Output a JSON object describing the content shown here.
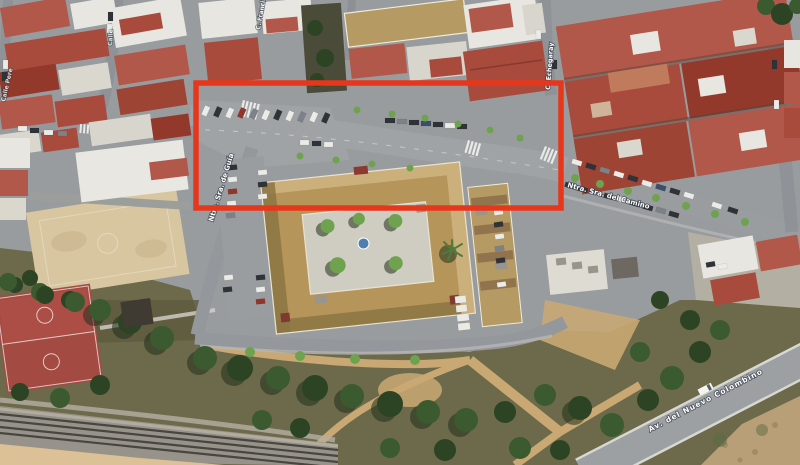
{
  "map": {
    "street_labels": [
      {
        "id": "ntra-sra-de-guia",
        "text": "Ntra. Sra. de Guía"
      },
      {
        "id": "ntra-sra-del-camino",
        "text": "Ntra. Sra. del Camino"
      },
      {
        "id": "echegaray",
        "text": "C. Echegaray"
      },
      {
        "id": "francisco",
        "text": "C. Francisco"
      },
      {
        "id": "calle-pere",
        "text": "Calle Pere"
      },
      {
        "id": "calle",
        "text": "Calle"
      },
      {
        "id": "nuevo-colombino",
        "text": "Av. del Nuevo Colombino"
      }
    ],
    "annotation": {
      "shape": "rectangle",
      "color": "#e6371d"
    }
  },
  "colors": {
    "annotation_red": "#e6371d",
    "roof_red": "#a84b3c",
    "school_roof_tan": "#b59559",
    "road_gray": "#9a9da0",
    "park_green": "#6d6a4b",
    "sand": "#c9a873",
    "court_red": "#a34a42",
    "rail_gray": "#98938a"
  }
}
